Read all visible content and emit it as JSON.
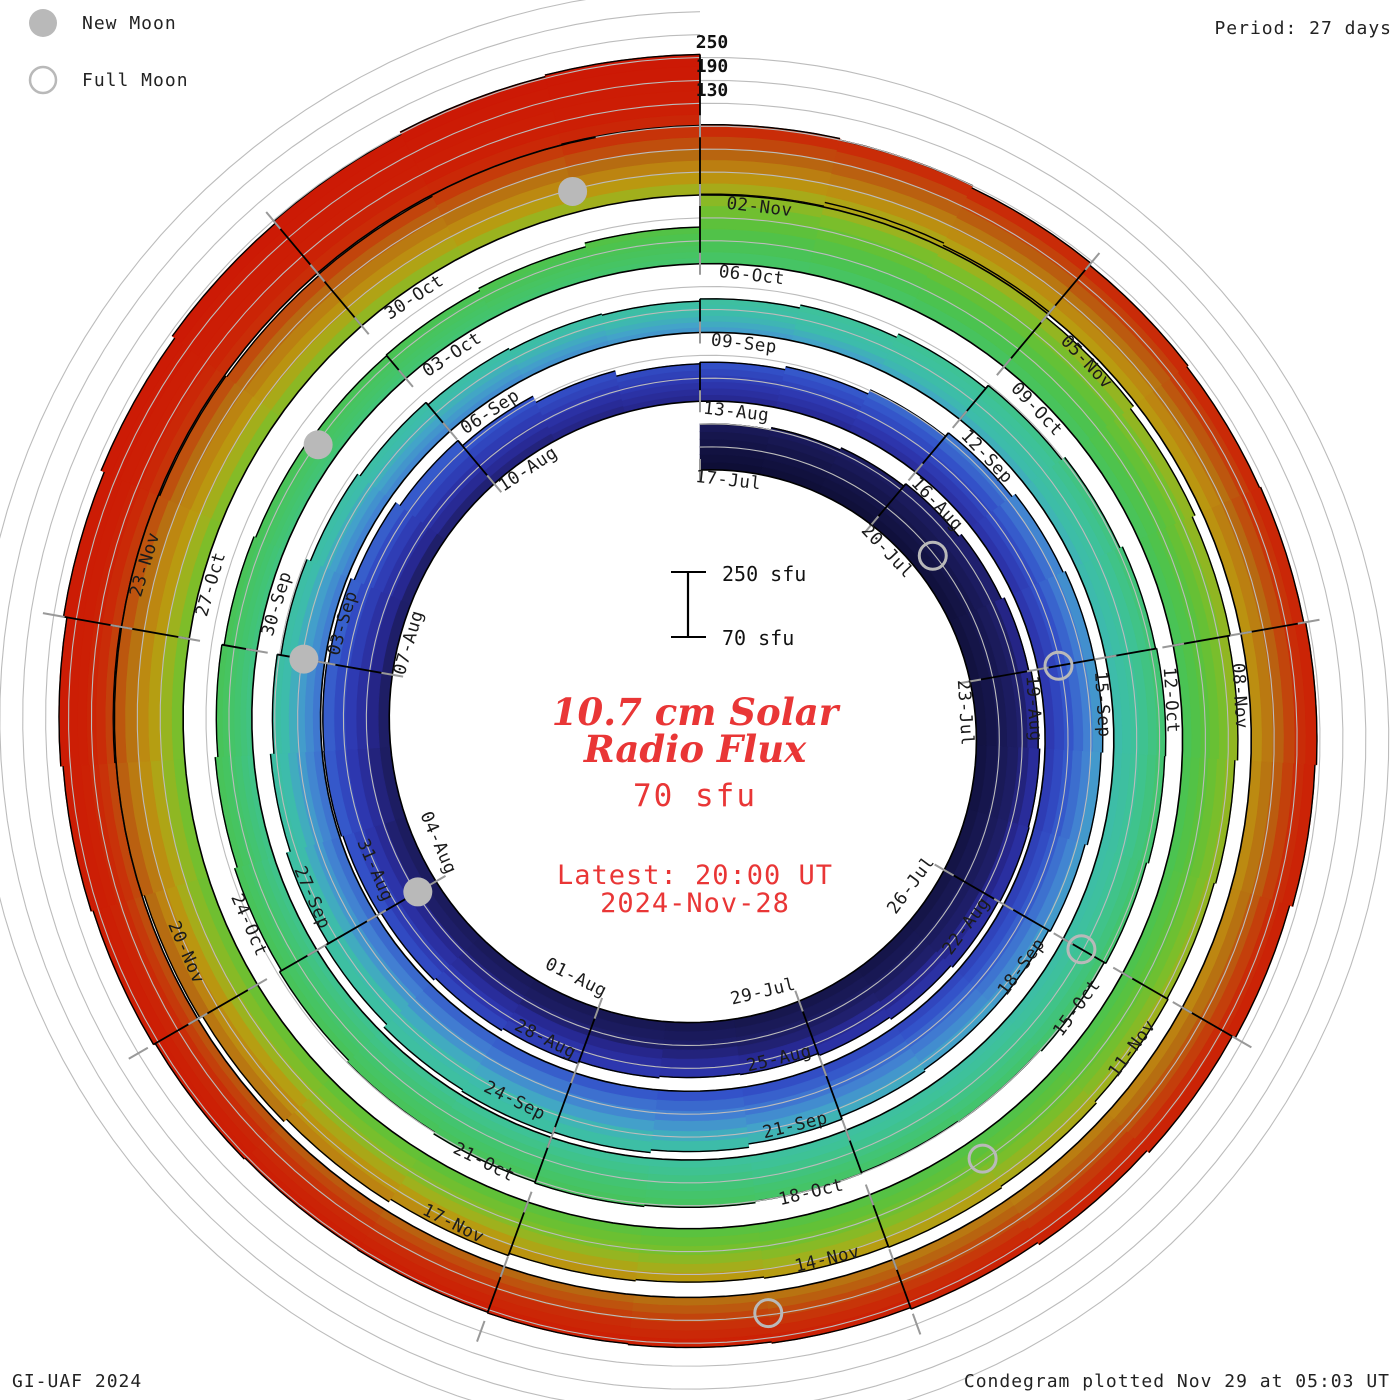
{
  "header": {
    "legend": [
      {
        "label": "New Moon",
        "marker": "filled-circle"
      },
      {
        "label": "Full Moon",
        "marker": "open-circle"
      }
    ],
    "period_label": "Period: 27 days"
  },
  "footer": {
    "left": "GI-UAF 2024",
    "right": "Condegram plotted Nov 29 at 05:03 UT"
  },
  "center_text": {
    "title_line1": "10.7 cm Solar",
    "title_line2": "Radio Flux",
    "unit_line": "70 sfu",
    "latest_line1": "Latest: 20:00 UT",
    "latest_line2": "2024-Nov-28"
  },
  "scale_bar": {
    "top_label": "250 sfu",
    "bottom_label": "70 sfu"
  },
  "radial_axis": {
    "labels": [
      "250",
      "190",
      "130"
    ]
  },
  "colors": {
    "background": "#ffffff",
    "grid": "#bcbcbc",
    "baseline": "#000000",
    "tick": "#999999",
    "date_label": "#1b1b1b",
    "moon": "#b9b9b9",
    "red_text": "#e93636",
    "black_text": "#111111"
  },
  "chart_data": {
    "type": "bar",
    "subtype": "polar-spiral-condegram",
    "title": "10.7 cm Solar Radio Flux",
    "units": "sfu",
    "period_days": 27,
    "days_per_label": 3,
    "start_date": "2024-07-17",
    "end_date": "2024-11-28",
    "flux_axis": {
      "min": 70,
      "max": 250,
      "gridlines": [
        130,
        190,
        250
      ]
    },
    "date_labels": [
      {
        "text": "17-Jul",
        "day": 0
      },
      {
        "text": "20-Jul",
        "day": 3
      },
      {
        "text": "23-Jul",
        "day": 6
      },
      {
        "text": "26-Jul",
        "day": 9
      },
      {
        "text": "29-Jul",
        "day": 12
      },
      {
        "text": "01-Aug",
        "day": 15
      },
      {
        "text": "04-Aug",
        "day": 18
      },
      {
        "text": "07-Aug",
        "day": 21
      },
      {
        "text": "10-Aug",
        "day": 24
      },
      {
        "text": "13-Aug",
        "day": 27
      },
      {
        "text": "16-Aug",
        "day": 30
      },
      {
        "text": "19-Aug",
        "day": 33
      },
      {
        "text": "22-Aug",
        "day": 36
      },
      {
        "text": "25-Aug",
        "day": 39
      },
      {
        "text": "28-Aug",
        "day": 42
      },
      {
        "text": "31-Aug",
        "day": 45
      },
      {
        "text": "03-Sep",
        "day": 48
      },
      {
        "text": "06-Sep",
        "day": 51
      },
      {
        "text": "09-Sep",
        "day": 54
      },
      {
        "text": "12-Sep",
        "day": 57
      },
      {
        "text": "15-Sep",
        "day": 60
      },
      {
        "text": "18-Sep",
        "day": 63
      },
      {
        "text": "21-Sep",
        "day": 66
      },
      {
        "text": "24-Sep",
        "day": 69
      },
      {
        "text": "27-Sep",
        "day": 72
      },
      {
        "text": "30-Sep",
        "day": 75
      },
      {
        "text": "03-Oct",
        "day": 78
      },
      {
        "text": "06-Oct",
        "day": 81
      },
      {
        "text": "09-Oct",
        "day": 84
      },
      {
        "text": "12-Oct",
        "day": 87
      },
      {
        "text": "15-Oct",
        "day": 90
      },
      {
        "text": "18-Oct",
        "day": 93
      },
      {
        "text": "21-Oct",
        "day": 96
      },
      {
        "text": "24-Oct",
        "day": 99
      },
      {
        "text": "27-Oct",
        "day": 102
      },
      {
        "text": "30-Oct",
        "day": 105
      },
      {
        "text": "02-Nov",
        "day": 108
      },
      {
        "text": "05-Nov",
        "day": 111
      },
      {
        "text": "08-Nov",
        "day": 114
      },
      {
        "text": "11-Nov",
        "day": 117
      },
      {
        "text": "14-Nov",
        "day": 120
      },
      {
        "text": "17-Nov",
        "day": 123
      },
      {
        "text": "20-Nov",
        "day": 126
      },
      {
        "text": "23-Nov",
        "day": 129
      }
    ],
    "daily_flux": [
      190,
      196,
      202,
      210,
      218,
      226,
      232,
      236,
      238,
      234,
      228,
      222,
      216,
      214,
      218,
      224,
      230,
      236,
      241,
      245,
      244,
      240,
      231,
      218,
      200,
      182,
      168,
      172,
      180,
      192,
      204,
      214,
      220,
      221,
      217,
      211,
      206,
      206,
      211,
      219,
      228,
      235,
      240,
      236,
      226,
      215,
      205,
      196,
      186,
      176,
      168,
      160,
      155,
      152,
      158,
      166,
      176,
      186,
      196,
      203,
      206,
      204,
      199,
      194,
      190,
      188,
      190,
      194,
      197,
      194,
      189,
      183,
      177,
      170,
      163,
      157,
      152,
      148,
      150,
      156,
      166,
      252,
      262,
      256,
      240,
      230,
      222,
      215,
      208,
      204,
      207,
      212,
      216,
      213,
      210,
      213,
      219,
      227,
      236,
      244,
      250,
      253,
      250,
      246,
      243,
      246,
      250,
      252,
      254,
      250,
      244,
      238,
      234,
      237,
      242,
      238,
      230,
      221,
      214,
      208,
      204,
      201,
      199,
      197,
      196,
      199,
      204,
      209,
      215,
      224,
      233,
      241,
      248,
      254,
      258
    ],
    "moons": [
      {
        "type": "full",
        "date": "2024-07-21",
        "day": 4
      },
      {
        "type": "new",
        "date": "2024-08-04",
        "day": 18
      },
      {
        "type": "full",
        "date": "2024-08-19",
        "day": 33
      },
      {
        "type": "new",
        "date": "2024-09-03",
        "day": 48
      },
      {
        "type": "full",
        "date": "2024-09-18",
        "day": 63
      },
      {
        "type": "new",
        "date": "2024-10-02",
        "day": 77
      },
      {
        "type": "full",
        "date": "2024-10-17",
        "day": 92
      },
      {
        "type": "new",
        "date": "2024-11-01",
        "day": 107
      },
      {
        "type": "full",
        "date": "2024-11-15",
        "day": 121
      }
    ],
    "rainbow_stops": [
      [
        0,
        "#0d0d33"
      ],
      [
        13,
        "#16164c"
      ],
      [
        24,
        "#1f1f6a"
      ],
      [
        27,
        "#26268c"
      ],
      [
        34,
        "#2d36ae"
      ],
      [
        42,
        "#3352c9"
      ],
      [
        50,
        "#4280d2"
      ],
      [
        56,
        "#43a3c9"
      ],
      [
        61,
        "#3dbcab"
      ],
      [
        70,
        "#3ec298"
      ],
      [
        80,
        "#43c46e"
      ],
      [
        90,
        "#4bc350"
      ],
      [
        98,
        "#60c138"
      ],
      [
        104,
        "#7cbe2a"
      ],
      [
        109,
        "#9fb11d"
      ],
      [
        113,
        "#b99b10"
      ],
      [
        118,
        "#bd8611"
      ],
      [
        123,
        "#b66c11"
      ],
      [
        128,
        "#c04b0d"
      ],
      [
        133,
        "#c92d08"
      ],
      [
        140,
        "#cc1f05"
      ],
      [
        162,
        "#cc1805"
      ]
    ],
    "layout": {
      "cx": 700,
      "cy": 729,
      "r0": 259,
      "ring_spacing": 68.75,
      "legend_position": "top-left",
      "grid": true
    }
  }
}
